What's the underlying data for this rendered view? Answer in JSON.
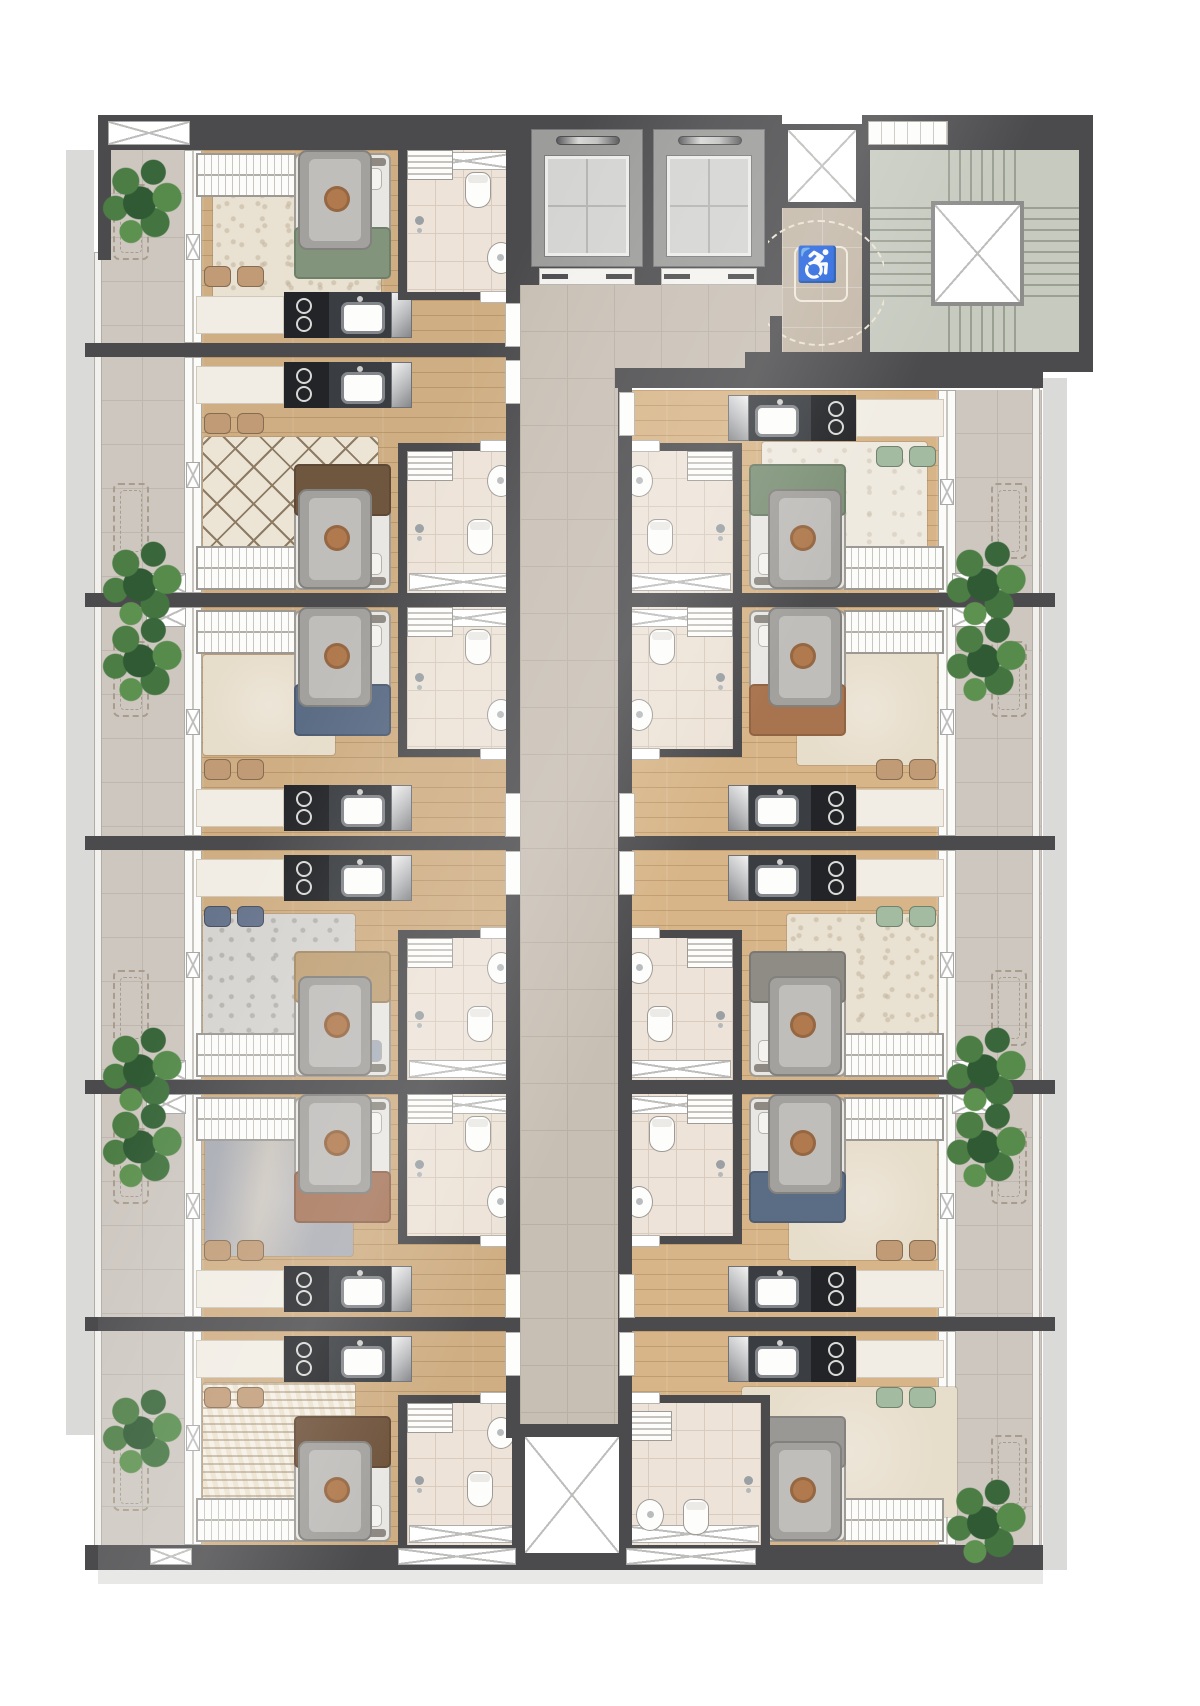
{
  "document": {
    "kind": "architectural-floor-plan",
    "description": "Rendered top-view floor plan of a residential storey with mirrored studio apartments along a central corridor, elevator bank, accessible lobby and stairwell at top, service shaft at bottom"
  },
  "symbols": {
    "accessible": "♿"
  },
  "palette": {
    "wall": "#4b4b4d",
    "corridor_tile": "#c8bfb4",
    "wood_floor": "#cfae83",
    "bath_tile": "#ede3d8",
    "balcony_tile": "#cdc7c0",
    "lobby_tan": "#c3b7a7",
    "stair_concrete": "#c6cabf",
    "plant_green": "#4c7d44",
    "shadow": "#dadad8",
    "counter_dark": "#3a3d41",
    "cooktop_black": "#222427",
    "fixture_white": "#fdfdfc"
  },
  "core": {
    "elevators": [
      {
        "name": "elevator-1"
      },
      {
        "name": "elevator-2"
      }
    ],
    "stairwell": {
      "name": "stairwell",
      "flights": 4,
      "central_void": true
    },
    "shafts": [
      {
        "name": "duct-shaft-top"
      },
      {
        "name": "service-shaft-bottom"
      }
    ],
    "accessible_lobby": {
      "name": "accessible-waiting-area",
      "symbol": "♿",
      "turning_circle": true
    }
  },
  "plan": {
    "canvas": {
      "width": 1200,
      "height": 1706
    },
    "units": [
      {
        "id": "L1",
        "side": "left",
        "top": 150,
        "height": 193,
        "orient": "kb",
        "variant": "standard",
        "colors": {
          "blanket": "#82957c",
          "accent": "#b98a69",
          "pillow": "#f4f3f0",
          "chairs": "#c09b76"
        },
        "rug": {
          "style": "fluff",
          "left": 115,
          "top": 32,
          "width": 168,
          "height": 120
        }
      },
      {
        "id": "L2",
        "side": "left",
        "top": 357,
        "height": 236,
        "orient": "kt",
        "variant": "standard",
        "colors": {
          "blanket": "#6e563f",
          "accent": "#a8744f",
          "pillow": "#f4f3f0",
          "chairs": "#c09b76"
        },
        "rug": {
          "style": "diamond",
          "left": 105,
          "top": 80,
          "width": 175,
          "height": 125
        }
      },
      {
        "id": "L3",
        "side": "left",
        "top": 607,
        "height": 229,
        "orient": "kb",
        "variant": "standard",
        "colors": {
          "blanket": "#5b6c85",
          "accent": "#8a6a4e",
          "pillow": "#f4f3f0",
          "chairs": "#c09b76"
        },
        "rug": {
          "style": "plain",
          "left": 105,
          "top": 48,
          "width": 132,
          "height": 100
        }
      },
      {
        "id": "L4",
        "side": "left",
        "top": 850,
        "height": 230,
        "orient": "kt",
        "variant": "standard",
        "colors": {
          "blanket": "#bfa177",
          "accent": "#9aa3b1",
          "pillow": "#aab2bd",
          "chairs": "#66748c"
        },
        "rug": {
          "style": "gray",
          "left": 105,
          "top": 64,
          "width": 152,
          "height": 128
        }
      },
      {
        "id": "L5",
        "side": "left",
        "top": 1094,
        "height": 223,
        "orient": "kb",
        "variant": "standard",
        "colors": {
          "blanket": "#a7765b",
          "accent": "#b8b0a4",
          "pillow": "#f4f3f0",
          "chairs": "#c09b76"
        },
        "rug": {
          "style": "blue",
          "left": 107,
          "top": 44,
          "width": 148,
          "height": 118
        }
      },
      {
        "id": "L6",
        "side": "left",
        "top": 1331,
        "height": 214,
        "orient": "kt",
        "variant": "standard",
        "colors": {
          "blanket": "#6e523b",
          "accent": "#9aa98f",
          "pillow": "#f4f3f0",
          "chairs": "#c09b76"
        },
        "rug": {
          "style": "zigzag",
          "left": 105,
          "top": 52,
          "width": 152,
          "height": 128
        }
      },
      {
        "id": "R1",
        "side": "right",
        "top": 390,
        "height": 203,
        "orient": "kt",
        "variant": "standard",
        "colors": {
          "blanket": "#7e9278",
          "accent": "#d8d4cc",
          "pillow": "#f4f3f0",
          "chairs": "#a3bba0"
        },
        "rug": {
          "style": "white",
          "left": 115,
          "top": 52,
          "width": 165,
          "height": 128
        }
      },
      {
        "id": "R2",
        "side": "right",
        "top": 607,
        "height": 229,
        "orient": "kb",
        "variant": "standard",
        "colors": {
          "blanket": "#a8744f",
          "accent": "#8a6a4e",
          "pillow": "#f4f3f0",
          "chairs": "#c09b76"
        },
        "rug": {
          "style": "plain",
          "left": 105,
          "top": 46,
          "width": 140,
          "height": 112
        }
      },
      {
        "id": "R3",
        "side": "right",
        "top": 850,
        "height": 230,
        "orient": "kt",
        "variant": "standard",
        "colors": {
          "blanket": "#8f8c86",
          "accent": "#6b7890",
          "pillow": "#f4f3f0",
          "chairs": "#a3bba0"
        },
        "rug": {
          "style": "fluff",
          "left": 105,
          "top": 64,
          "width": 150,
          "height": 126
        }
      },
      {
        "id": "R4",
        "side": "right",
        "top": 1094,
        "height": 223,
        "orient": "kb",
        "variant": "standard",
        "colors": {
          "blanket": "#5b6c85",
          "accent": "#bfa177",
          "pillow": "#f4f3f0",
          "chairs": "#c09b76"
        },
        "rug": {
          "style": "plain",
          "left": 105,
          "top": 46,
          "width": 148,
          "height": 120
        }
      },
      {
        "id": "R5",
        "side": "right",
        "top": 1331,
        "height": 214,
        "orient": "kt",
        "variant": "sofa",
        "colors": {
          "blanket": "#9a9894",
          "accent": "#b07a4e",
          "pillow": "#f4f3f0",
          "chairs": "#a3bba0"
        },
        "rug": {
          "style": "plain",
          "left": 85,
          "top": 56,
          "width": 215,
          "height": 130
        }
      }
    ],
    "party_walls": {
      "left": [
        343,
        593,
        836,
        1080,
        1317
      ],
      "right": [
        593,
        836,
        1080,
        1317
      ]
    },
    "balcony_dividers": {
      "left": [
        343,
        593,
        836,
        1080,
        1317
      ],
      "right": [
        593,
        836,
        1080,
        1317
      ]
    },
    "vents": {
      "left_balcony": [
        573,
        607,
        1060,
        1094
      ],
      "right_balcony": [
        573,
        607,
        1060,
        1094
      ]
    },
    "bottom_windows": [
      {
        "x": 150,
        "w": 42
      },
      {
        "x": 398,
        "w": 118
      },
      {
        "x": 626,
        "w": 130
      }
    ],
    "doors": {
      "left": [
        303,
        360,
        793,
        851,
        1274,
        1332
      ],
      "right": [
        392,
        793,
        851,
        1274,
        1332
      ]
    },
    "plants": [
      {
        "side": "left",
        "x": 100,
        "y": 156
      },
      {
        "side": "left",
        "x": 100,
        "y": 538
      },
      {
        "side": "left",
        "x": 100,
        "y": 614
      },
      {
        "side": "left",
        "x": 100,
        "y": 1024
      },
      {
        "side": "left",
        "x": 100,
        "y": 1100
      },
      {
        "side": "left",
        "x": 100,
        "y": 1386
      },
      {
        "side": "right",
        "x": 944,
        "y": 538
      },
      {
        "side": "right",
        "x": 944,
        "y": 614
      },
      {
        "side": "right",
        "x": 944,
        "y": 1024
      },
      {
        "side": "right",
        "x": 944,
        "y": 1100
      },
      {
        "side": "right",
        "x": 944,
        "y": 1476
      }
    ]
  }
}
